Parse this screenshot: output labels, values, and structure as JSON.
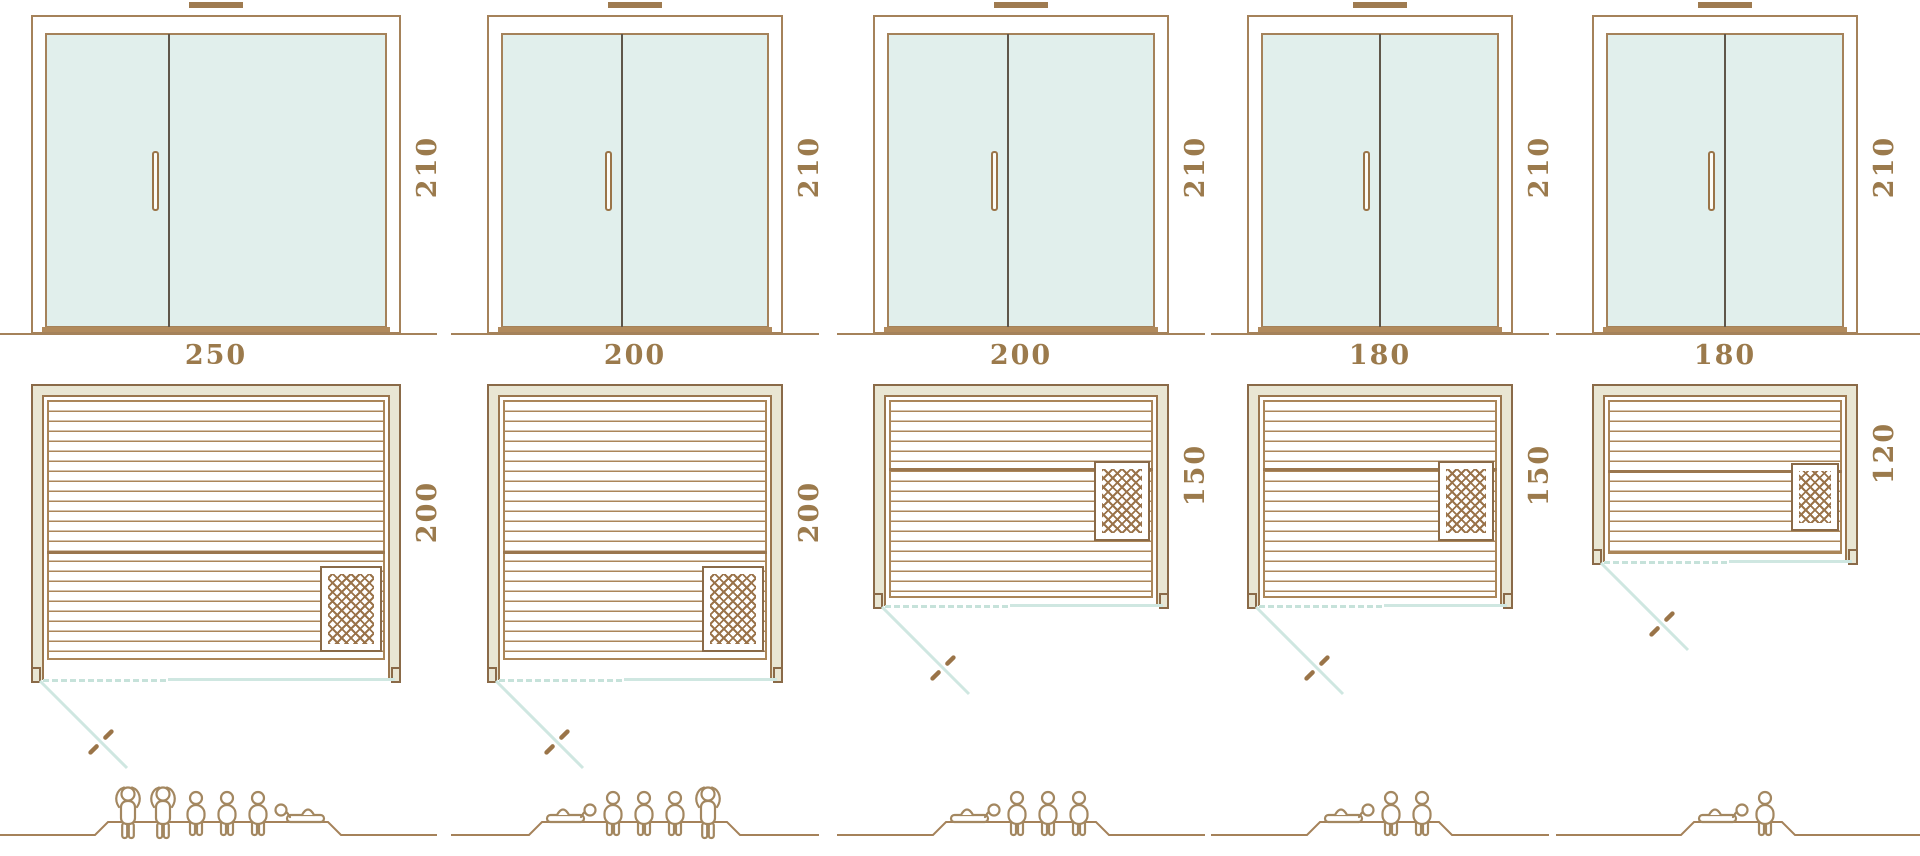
{
  "diagram_title": "sauna-size-comparison",
  "palette": {
    "line_tan": "#a5825a",
    "line_dark_brown": "#8a6a48",
    "glass_fill": "#e1efec",
    "wall_fill": "#e9e6d3",
    "teal_door_line": "#cfe7e1",
    "label_text": "#9b7a4c",
    "figure_outline": "#a38760",
    "door_divider": "#5f564a"
  },
  "columns": [
    {
      "name": "variant-250x200",
      "height_label": "210",
      "width_label": "250",
      "depth_label": "200",
      "height_cm": 210,
      "width_cm": 250,
      "depth_cm": 200,
      "heater_position": "bottom-right",
      "capacity_count": 6,
      "capacity_figures": [
        "standing",
        "standing",
        "sitting",
        "sitting",
        "sitting",
        "lying-head-left"
      ]
    },
    {
      "name": "variant-200x200",
      "height_label": "210",
      "width_label": "200",
      "depth_label": "200",
      "height_cm": 210,
      "width_cm": 200,
      "depth_cm": 200,
      "heater_position": "bottom-right",
      "capacity_count": 5,
      "capacity_figures": [
        "lying-head-right",
        "sitting",
        "sitting",
        "sitting",
        "standing"
      ]
    },
    {
      "name": "variant-200x150",
      "height_label": "210",
      "width_label": "200",
      "depth_label": "150",
      "height_cm": 210,
      "width_cm": 200,
      "depth_cm": 150,
      "heater_position": "right-middle",
      "capacity_count": 4,
      "capacity_figures": [
        "lying-head-right",
        "sitting",
        "sitting",
        "sitting"
      ]
    },
    {
      "name": "variant-180x150",
      "height_label": "210",
      "width_label": "180",
      "depth_label": "150",
      "height_cm": 210,
      "width_cm": 180,
      "depth_cm": 150,
      "heater_position": "right-middle",
      "capacity_count": 3,
      "capacity_figures": [
        "lying-head-right",
        "sitting",
        "sitting"
      ]
    },
    {
      "name": "variant-180x120",
      "height_label": "210",
      "width_label": "180",
      "depth_label": "120",
      "height_cm": 210,
      "width_cm": 180,
      "depth_cm": 120,
      "heater_position": "right-low",
      "capacity_count": 2,
      "capacity_figures": [
        "lying-head-right",
        "sitting"
      ]
    }
  ]
}
